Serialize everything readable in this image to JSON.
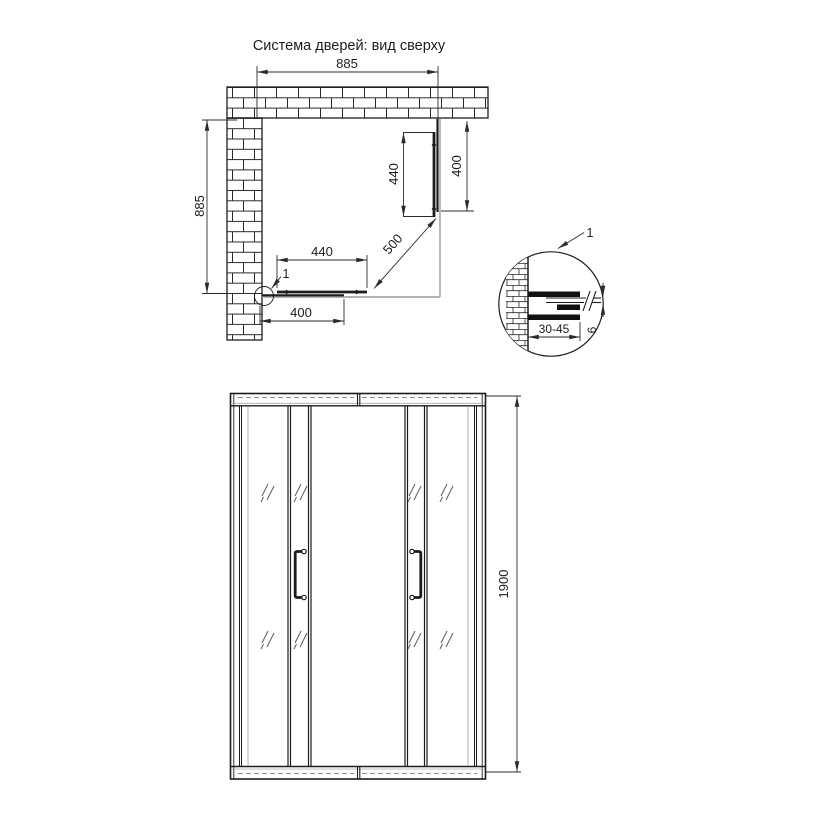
{
  "page": {
    "background": "#ffffff",
    "line_color": "#1c1c1c",
    "dim_color": "#2b2b2b",
    "tray_color": "#9c9c9c"
  },
  "plan_view": {
    "title": "Система дверей: вид сверху",
    "dim_width_top": "885",
    "dim_depth_left": "885",
    "dim_door_right": "440",
    "dim_fixed_right": "400",
    "dim_door_bottom": "440",
    "dim_fixed_bottom": "400",
    "dim_diagonal_opening": "500",
    "detail_ref": "1"
  },
  "detail_view": {
    "ref_label": "1",
    "dim_profile_adjustment": "30-45",
    "dim_glass_thickness": "6"
  },
  "front_view": {
    "dim_height": "1900"
  }
}
